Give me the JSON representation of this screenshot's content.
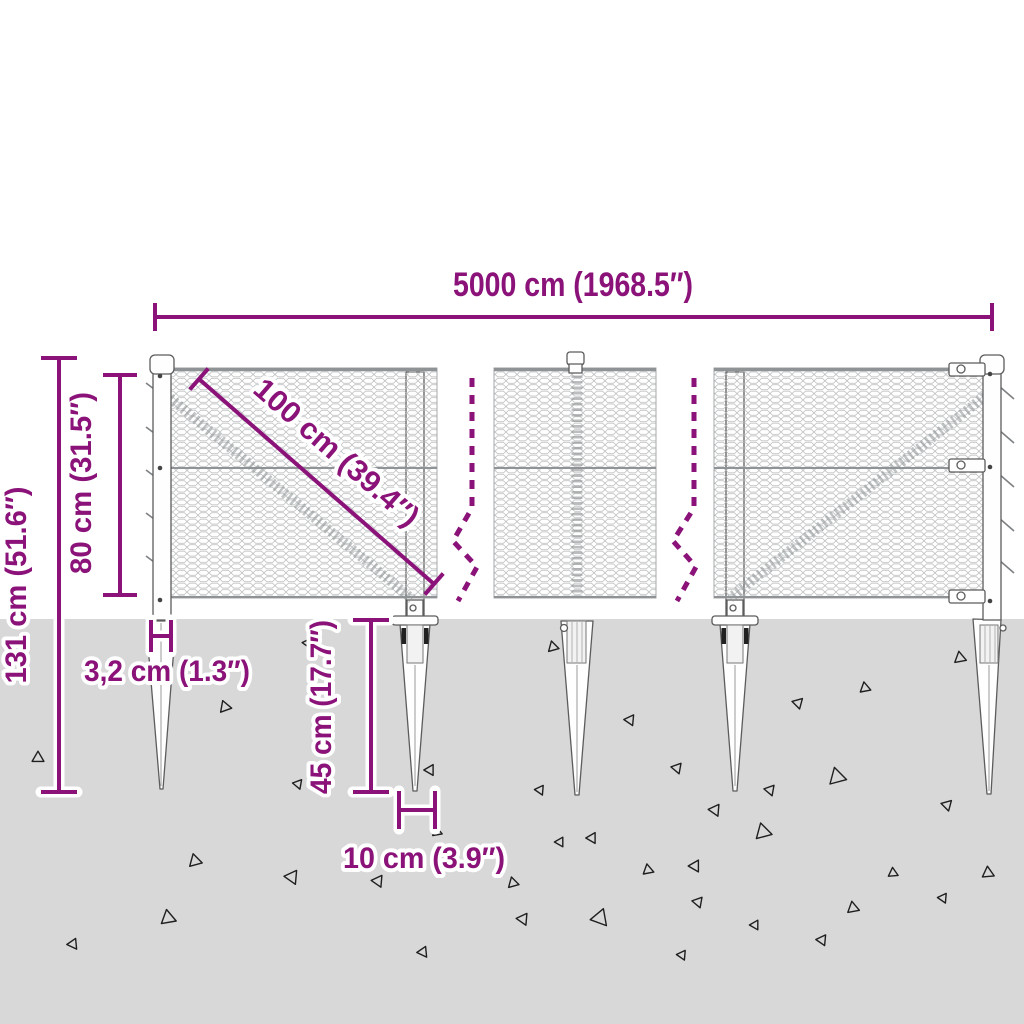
{
  "dims": {
    "total_width": "5000 cm (1968.5″)",
    "total_height": "131 cm (51.6″)",
    "mesh_height": "80 cm (31.5″)",
    "panel_diagonal": "100 cm (39.4″)",
    "post_width": "3,2 cm (1.3″)",
    "spike_depth": "45 cm (17.7″)",
    "spike_width": "10 cm (3.9″)"
  },
  "colors": {
    "dimension": "#8a1278",
    "ground": "#d8d8d8",
    "mesh": "#b5b8ba",
    "outline": "#5c5c5c"
  },
  "ground": {
    "triangles": [
      [
        38,
        758,
        11,
        0
      ],
      [
        225,
        707,
        11,
        20
      ],
      [
        298,
        784,
        9,
        200
      ],
      [
        307,
        643,
        8,
        205
      ],
      [
        195,
        861,
        12,
        15
      ],
      [
        292,
        877,
        13,
        205
      ],
      [
        168,
        918,
        14,
        10
      ],
      [
        73,
        944,
        10,
        215
      ],
      [
        378,
        881,
        11,
        205
      ],
      [
        430,
        770,
        10,
        210
      ],
      [
        437,
        832,
        9,
        10
      ],
      [
        423,
        952,
        10,
        215
      ],
      [
        513,
        883,
        10,
        15
      ],
      [
        523,
        919,
        11,
        205
      ],
      [
        560,
        842,
        9,
        210
      ],
      [
        553,
        647,
        10,
        15
      ],
      [
        600,
        918,
        16,
        220
      ],
      [
        630,
        720,
        10,
        205
      ],
      [
        648,
        870,
        10,
        10
      ],
      [
        677,
        768,
        10,
        200
      ],
      [
        682,
        955,
        9,
        205
      ],
      [
        695,
        866,
        11,
        210
      ],
      [
        698,
        902,
        10,
        200
      ],
      [
        715,
        810,
        11,
        205
      ],
      [
        540,
        790,
        9,
        205
      ],
      [
        592,
        838,
        10,
        210
      ],
      [
        755,
        925,
        9,
        210
      ],
      [
        763,
        832,
        15,
        15
      ],
      [
        770,
        790,
        10,
        200
      ],
      [
        798,
        703,
        10,
        195
      ],
      [
        822,
        940,
        10,
        205
      ],
      [
        837,
        777,
        16,
        15
      ],
      [
        853,
        908,
        11,
        10
      ],
      [
        865,
        688,
        10,
        10
      ],
      [
        893,
        873,
        9,
        5
      ],
      [
        943,
        898,
        9,
        205
      ],
      [
        947,
        805,
        10,
        195
      ],
      [
        960,
        658,
        11,
        10
      ],
      [
        988,
        873,
        11,
        5
      ]
    ]
  }
}
